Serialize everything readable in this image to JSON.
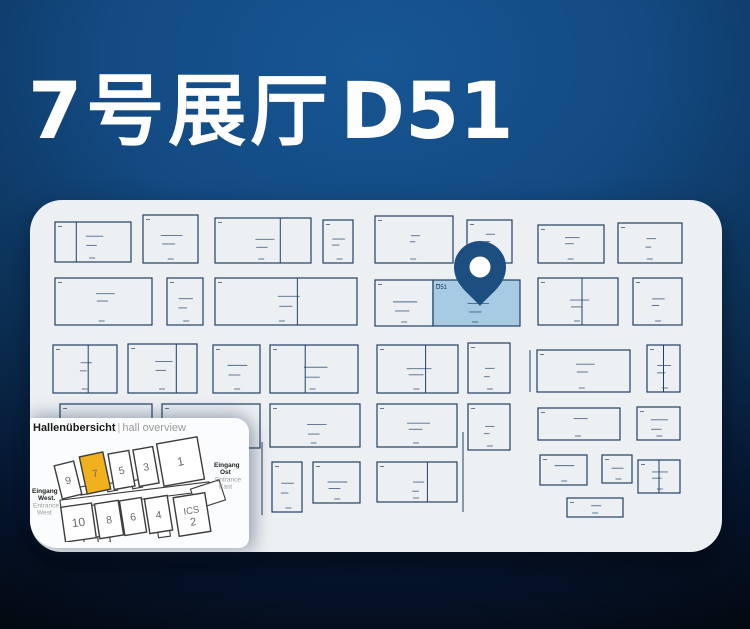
{
  "title": {
    "hall_cn": "7号展厅",
    "booth": "D51"
  },
  "colors": {
    "bg_center": "#175694",
    "bg_dark": "#03070d",
    "card": "#edf0f3",
    "booth_line": "#203f64",
    "booth_mark": "#2a4a70",
    "highlight_fill": "#a6cbe3",
    "pin": "#1c4e7f",
    "pin_hole": "#ffffff",
    "hall_line": "#3c3c3c",
    "hall_fill": "#ffffff",
    "hall_highlight": "#f0b11c",
    "hall_number": "#6a6a6a",
    "entrance_bold": "#222222",
    "entrance_gray": "#9a9a9a"
  },
  "floorplan": {
    "highlight_label": "D51",
    "booths": [
      {
        "x": 25,
        "y": 22,
        "w": 76,
        "h": 40,
        "d": [
          0.28
        ]
      },
      {
        "x": 113,
        "y": 15,
        "w": 55,
        "h": 48
      },
      {
        "x": 185,
        "y": 18,
        "w": 96,
        "h": 45,
        "d": [
          0.68
        ]
      },
      {
        "x": 293,
        "y": 20,
        "w": 30,
        "h": 43
      },
      {
        "x": 345,
        "y": 16,
        "w": 78,
        "h": 47
      },
      {
        "x": 437,
        "y": 20,
        "w": 45,
        "h": 43
      },
      {
        "x": 508,
        "y": 25,
        "w": 66,
        "h": 38
      },
      {
        "x": 588,
        "y": 23,
        "w": 64,
        "h": 40
      },
      {
        "x": 25,
        "y": 78,
        "w": 97,
        "h": 47
      },
      {
        "x": 137,
        "y": 78,
        "w": 36,
        "h": 47
      },
      {
        "x": 185,
        "y": 78,
        "w": 142,
        "h": 47,
        "d": [
          0.58
        ]
      },
      {
        "x": 345,
        "y": 80,
        "w": 58,
        "h": 46
      },
      {
        "x": 403,
        "y": 80,
        "w": 87,
        "h": 46,
        "hl": true
      },
      {
        "x": 508,
        "y": 78,
        "w": 80,
        "h": 47,
        "d": [
          0.55
        ]
      },
      {
        "x": 603,
        "y": 78,
        "w": 49,
        "h": 47
      },
      {
        "x": 23,
        "y": 145,
        "w": 64,
        "h": 48,
        "d": [
          0.55
        ]
      },
      {
        "x": 98,
        "y": 144,
        "w": 69,
        "h": 49,
        "d": [
          0.7
        ]
      },
      {
        "x": 183,
        "y": 145,
        "w": 47,
        "h": 48
      },
      {
        "x": 240,
        "y": 145,
        "w": 88,
        "h": 48,
        "d": [
          0.4
        ]
      },
      {
        "x": 347,
        "y": 145,
        "w": 81,
        "h": 48,
        "d": [
          0.6
        ]
      },
      {
        "x": 438,
        "y": 143,
        "w": 42,
        "h": 50
      },
      {
        "x": 507,
        "y": 150,
        "w": 93,
        "h": 42
      },
      {
        "x": 617,
        "y": 145,
        "w": 33,
        "h": 47,
        "d": [
          0.5
        ]
      },
      {
        "x": 30,
        "y": 204,
        "w": 92,
        "h": 44
      },
      {
        "x": 132,
        "y": 204,
        "w": 98,
        "h": 44
      },
      {
        "x": 240,
        "y": 204,
        "w": 90,
        "h": 43
      },
      {
        "x": 347,
        "y": 204,
        "w": 80,
        "h": 43
      },
      {
        "x": 438,
        "y": 204,
        "w": 42,
        "h": 46
      },
      {
        "x": 508,
        "y": 208,
        "w": 82,
        "h": 32
      },
      {
        "x": 607,
        "y": 207,
        "w": 43,
        "h": 33
      },
      {
        "x": 242,
        "y": 262,
        "w": 30,
        "h": 50
      },
      {
        "x": 283,
        "y": 262,
        "w": 47,
        "h": 41
      },
      {
        "x": 347,
        "y": 262,
        "w": 80,
        "h": 40,
        "d": [
          0.63
        ]
      },
      {
        "x": 510,
        "y": 255,
        "w": 47,
        "h": 30
      },
      {
        "x": 572,
        "y": 255,
        "w": 30,
        "h": 28
      },
      {
        "x": 608,
        "y": 260,
        "w": 42,
        "h": 33,
        "d": [
          0.5
        ]
      },
      {
        "x": 537,
        "y": 298,
        "w": 56,
        "h": 19
      }
    ],
    "aisle_lines": [
      [
        232,
        242,
        232,
        315
      ],
      [
        433,
        232,
        433,
        312
      ],
      [
        500,
        150,
        500,
        192
      ]
    ],
    "pin": {
      "cx": 450,
      "cy": 67,
      "r": 26,
      "hole_r": 10.5,
      "tip_y": 106
    }
  },
  "overview": {
    "title_de": "Hallenübersicht",
    "title_sep": "|",
    "title_en": "hall overview",
    "halls": [
      {
        "label": "9",
        "x": 28,
        "y": 29,
        "w": 20,
        "h": 34,
        "rot": -14
      },
      {
        "label": "7",
        "x": 53,
        "y": 20,
        "w": 24,
        "h": 38,
        "rot": -12,
        "highlight": true
      },
      {
        "label": "5",
        "x": 81,
        "y": 18,
        "w": 21,
        "h": 36,
        "rot": -10
      },
      {
        "label": "3",
        "x": 106,
        "y": 14,
        "w": 20,
        "h": 37,
        "rot": -10
      },
      {
        "label": "1",
        "x": 130,
        "y": 6,
        "w": 41,
        "h": 43,
        "rot": -10
      },
      {
        "label": "10",
        "x": 33,
        "y": 71,
        "w": 31,
        "h": 35,
        "rot": -8
      },
      {
        "label": "8",
        "x": 67,
        "y": 68,
        "w": 24,
        "h": 35,
        "rot": -9
      },
      {
        "label": "6",
        "x": 92,
        "y": 65,
        "w": 22,
        "h": 35,
        "rot": -9
      },
      {
        "label": "4",
        "x": 117,
        "y": 63,
        "w": 23,
        "h": 35,
        "rot": -9
      },
      {
        "label": "ICS 2",
        "x": 146,
        "y": 61,
        "w": 32,
        "h": 39,
        "rot": -9
      }
    ],
    "connectors": [
      {
        "x": 30,
        "y": 57,
        "w": 150,
        "h": 9,
        "rot": -7
      },
      {
        "x": 163,
        "y": 50,
        "w": 30,
        "h": 21,
        "rot": -18
      },
      {
        "x": 50,
        "y": 52,
        "w": 12,
        "h": 8,
        "rot": -11
      },
      {
        "x": 77,
        "y": 49,
        "w": 10,
        "h": 8,
        "rot": -10
      },
      {
        "x": 102,
        "y": 46,
        "w": 10,
        "h": 8,
        "rot": -10
      },
      {
        "x": 40,
        "y": 104,
        "w": 14,
        "h": 7,
        "rot": -8
      },
      {
        "x": 68,
        "y": 102,
        "w": 12,
        "h": 7,
        "rot": -8
      },
      {
        "x": 128,
        "y": 96,
        "w": 12,
        "h": 7,
        "rot": -8
      }
    ],
    "entrance_west": {
      "bold": [
        "Eingang",
        "West."
      ],
      "gray": [
        "Entrance",
        "West"
      ],
      "x": 2,
      "y": 59
    },
    "entrance_east": {
      "bold": [
        "Eingang",
        "Ost"
      ],
      "gray": [
        "Entrance",
        "East"
      ],
      "x": 184,
      "y": 33
    }
  }
}
